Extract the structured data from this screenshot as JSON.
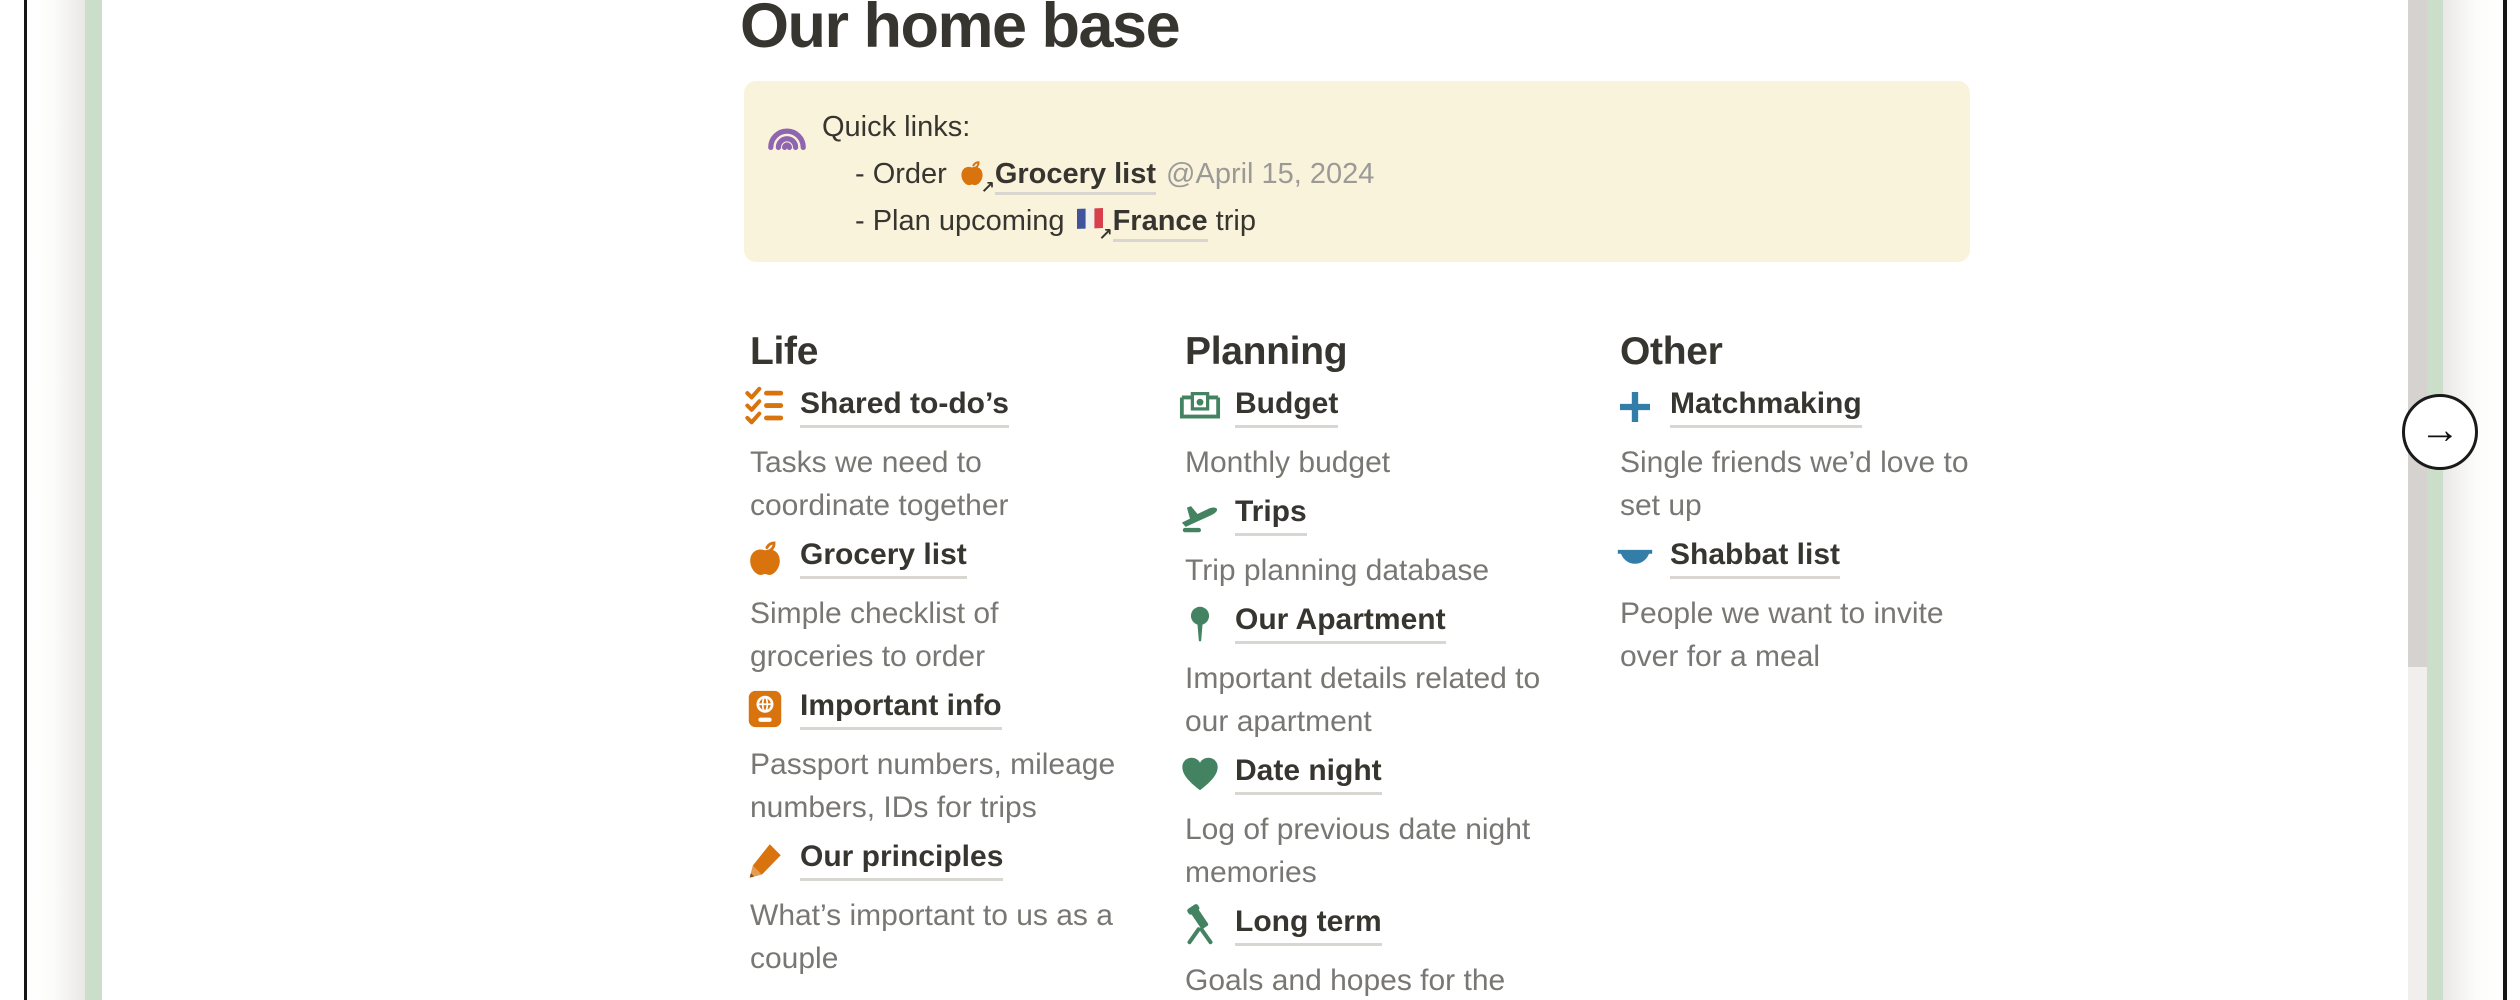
{
  "page": {
    "title": "Our home base",
    "callout": {
      "bg_color": "#FAF3DC",
      "icon": "rainbow-icon",
      "title": "Quick links:",
      "links": [
        {
          "prefix": "- Order",
          "icon": "apple-icon",
          "link": "Grocery list",
          "date": "@April 15, 2024"
        },
        {
          "prefix": "- Plan upcoming",
          "icon": "france-flag-icon",
          "link": "France",
          "suffix": "trip"
        }
      ]
    },
    "columns": [
      {
        "heading": "Life",
        "accent": "#D9730D",
        "items": [
          {
            "icon": "checklist-icon",
            "label": "Shared to-do’s",
            "desc": [
              "Tasks we need to",
              "coordinate together"
            ]
          },
          {
            "icon": "apple-icon",
            "label": "Grocery list",
            "desc": [
              "Simple checklist of",
              "groceries to order"
            ]
          },
          {
            "icon": "passport-icon",
            "label": "Important info",
            "desc": [
              "Passport numbers, mileage",
              "numbers, IDs for trips"
            ]
          },
          {
            "icon": "pencil-icon",
            "label": "Our principles",
            "desc": [
              "What’s important to us as a",
              "couple"
            ]
          }
        ]
      },
      {
        "heading": "Planning",
        "accent": "#448361",
        "items": [
          {
            "icon": "banknote-icon",
            "label": "Budget",
            "desc": [
              "Monthly budget"
            ]
          },
          {
            "icon": "airplane-icon",
            "label": "Trips",
            "desc": [
              "Trip planning database"
            ]
          },
          {
            "icon": "map-pin-icon",
            "label": "Our Apartment",
            "desc": [
              "Important details related to",
              "our apartment"
            ]
          },
          {
            "icon": "heart-icon",
            "label": "Date night",
            "desc": [
              "Log of previous date night",
              "memories"
            ]
          },
          {
            "icon": "telescope-icon",
            "label": "Long term",
            "desc": [
              "Goals and hopes for the"
            ]
          }
        ]
      },
      {
        "heading": "Other",
        "accent": "#337EA9",
        "items": [
          {
            "icon": "plus-icon",
            "label": "Matchmaking",
            "desc": [
              "Single friends we’d love to",
              "set up"
            ]
          },
          {
            "icon": "bowl-icon",
            "label": "Shabbat list",
            "desc": [
              "People we want to invite",
              "over for a meal"
            ]
          }
        ]
      }
    ]
  },
  "carousel": {
    "next_button_glyph": "→",
    "external_arrow_glyph": "↗",
    "card_edge_color": "#CBDECA",
    "scrollbar_thumb_color": "#D5D2CF",
    "scrollbar_track_color": "#F1EFED",
    "border_color": "#161616"
  },
  "colors": {
    "text": "#37352F",
    "secondary_text": "#787774",
    "date_text": "#9B9A97",
    "orange": "#D9730D",
    "green": "#448361",
    "blue": "#337EA9",
    "purple": "#9065B0",
    "callout_bg": "#FAF3DC"
  }
}
